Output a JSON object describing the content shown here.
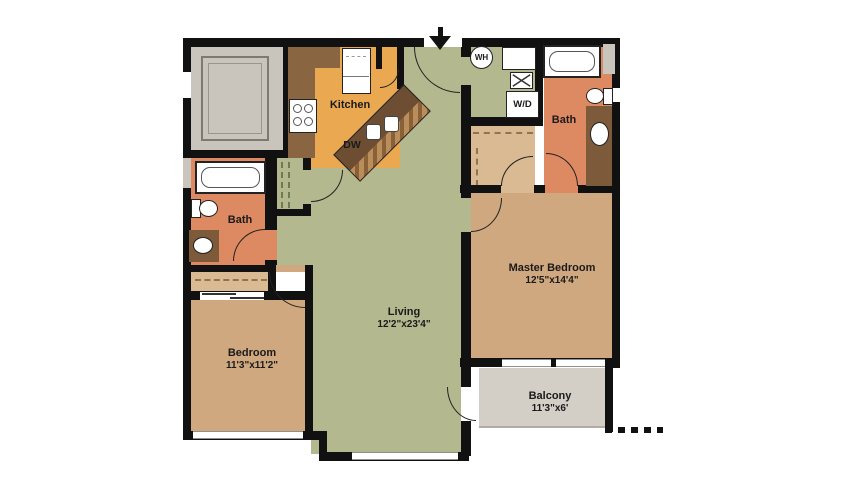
{
  "plan": {
    "rooms": {
      "kitchen": {
        "label": "Kitchen"
      },
      "living": {
        "label": "Living",
        "dims": "12'2\"x23'4\""
      },
      "master_bedroom": {
        "label": "Master Bedroom",
        "dims": "12'5\"x14'4\""
      },
      "bedroom": {
        "label": "Bedroom",
        "dims": "11'3\"x11'2\""
      },
      "bath_main": {
        "label": "Bath"
      },
      "bath_master": {
        "label": "Bath"
      },
      "balcony": {
        "label": "Balcony",
        "dims": "11'3\"x6'"
      }
    },
    "labels": {
      "dishwasher": "DW",
      "water_heater": "WH",
      "washer_dryer": "W/D"
    },
    "colors": {
      "wall": "#111111",
      "living_floor": "#b4b88e",
      "bedroom_floor": "#cfa87f",
      "closet_floor": "#d9ba92",
      "bath_floor": "#dd8a62",
      "kitchen_floor": "#eaa851",
      "counter": "#8a6542",
      "island": "#6e4e33",
      "island_edge": "#b98e5c",
      "vanity": "#7d5b3a",
      "storage_floor": "#c9c5bc",
      "balcony_floor": "#d3cfc7",
      "text": "#1a1a1a"
    }
  }
}
